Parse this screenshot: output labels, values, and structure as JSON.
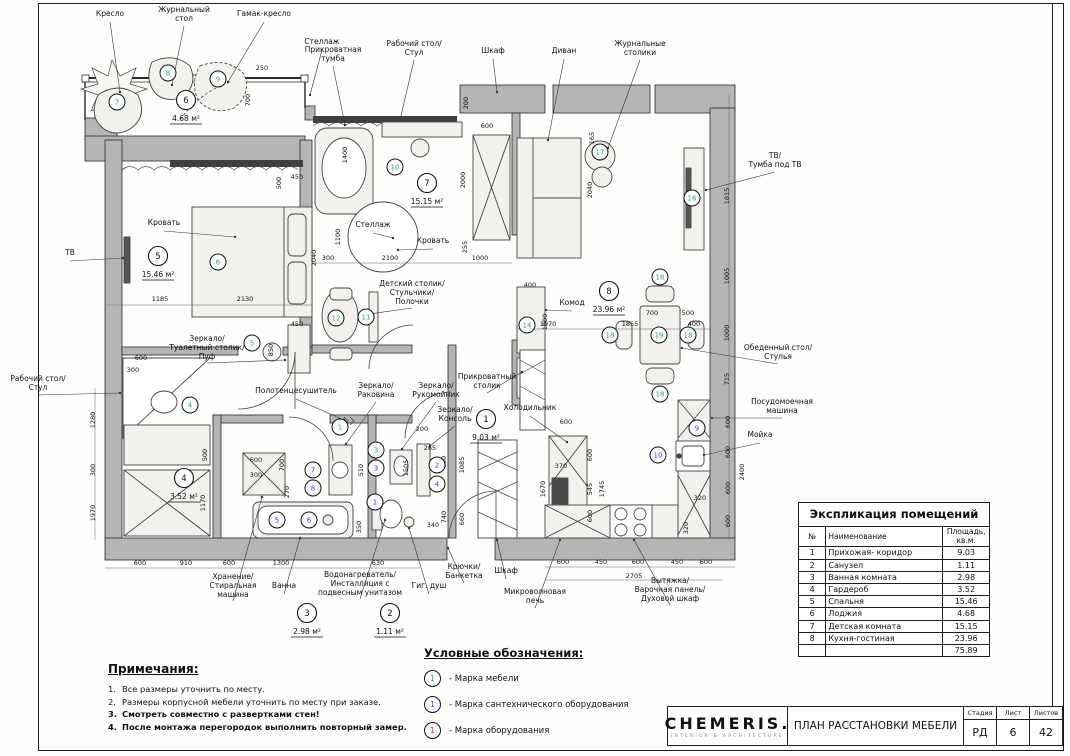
{
  "colors": {
    "furniture": "#2f9e8c",
    "plumbing": "#3646c8",
    "equipment": "#c04040",
    "wall": "#b5b5b5"
  },
  "titleBlock": {
    "logo": "CHEMERIS.",
    "logoSub": "INTERIOR & ARCHITECTURE",
    "docTitle": "ПЛАН РАССТАНОВКИ МЕБЕЛИ",
    "stageLabel": "Стадия",
    "sheetLabel": "Лист",
    "sheetsLabel": "Листов",
    "stage": "РД",
    "sheetNo": "6",
    "sheetsTotal": "42"
  },
  "explication": {
    "title": "Экспликация помещений",
    "colNo": "№",
    "colName": "Наименование",
    "colArea": "Площадь, кв.м.",
    "rows": [
      [
        "1",
        "Прихожая- коридор",
        "9.03"
      ],
      [
        "2",
        "Санузел",
        "1.11"
      ],
      [
        "3",
        "Ванная комната",
        "2.98"
      ],
      [
        "4",
        "Гардероб",
        "3.52"
      ],
      [
        "5",
        "Спальня",
        "15.46"
      ],
      [
        "6",
        "Лоджия",
        "4.68"
      ],
      [
        "7",
        "Детская комната",
        "15.15"
      ],
      [
        "8",
        "Кухня-гостиная",
        "23.96"
      ]
    ],
    "total": "75.89"
  },
  "legend": {
    "title": "Условные обозначения:",
    "items": [
      {
        "num": "1",
        "type": "furniture",
        "text": "- Марка мебели"
      },
      {
        "num": "1",
        "type": "plumbing",
        "text": "- Марка сантехнического оборудования"
      },
      {
        "num": "1",
        "type": "equipment",
        "text": "- Марка оборудования"
      }
    ]
  },
  "notes": {
    "title": "Примечания:",
    "items": [
      {
        "text": "Все размеры уточнить по месту.",
        "bold": false
      },
      {
        "text": "Размеры корпусной мебели уточнить по месту при заказе.",
        "bold": false
      },
      {
        "text": "Смотреть совместно с развертками стен!",
        "bold": true
      },
      {
        "text": "После монтажа перегородок выполнить повторный замер.",
        "bold": true
      }
    ]
  },
  "plan": {
    "roomMarks": [
      {
        "num": "5",
        "area": "15.46 м²",
        "x": 158,
        "y": 256
      },
      {
        "num": "6",
        "area": "4.68 м²",
        "x": 186,
        "y": 100
      },
      {
        "num": "7",
        "area": "15.15 м²",
        "x": 427,
        "y": 183
      },
      {
        "num": "8",
        "area": "23.96 м²",
        "x": 609,
        "y": 291
      },
      {
        "num": "4",
        "area": "3.52 м²",
        "x": 184,
        "y": 478
      },
      {
        "num": "1",
        "area": "9.03 м²",
        "x": 486,
        "y": 419
      },
      {
        "num": "3",
        "area": "2.98 м²",
        "x": 307,
        "y": 613
      },
      {
        "num": "2",
        "area": "1.11 м²",
        "x": 390,
        "y": 613
      }
    ],
    "labels": [
      {
        "text": "Кресло",
        "x": 110,
        "y": 16,
        "lx": 120,
        "ly": 92
      },
      {
        "text": "Журнальный\nстол",
        "x": 184,
        "y": 12,
        "lx": 172,
        "ly": 85
      },
      {
        "text": "Гамак-кресло",
        "x": 264,
        "y": 16,
        "lx": 228,
        "ly": 82
      },
      {
        "text": "Стеллаж",
        "x": 322,
        "y": 44,
        "lx": 310,
        "ly": 95
      },
      {
        "text": "Прикроватная\nтумба",
        "x": 333,
        "y": 52,
        "lx": 345,
        "ly": 125
      },
      {
        "text": "Рабочий стол/\nСтул",
        "x": 414,
        "y": 46,
        "lx": 400,
        "ly": 120
      },
      {
        "text": "Шкаф",
        "x": 493,
        "y": 53,
        "lx": 497,
        "ly": 92
      },
      {
        "text": "Диван",
        "x": 564,
        "y": 53,
        "lx": 548,
        "ly": 140
      },
      {
        "text": "Журнальные\nстолики",
        "x": 640,
        "y": 46,
        "lx": 608,
        "ly": 148
      },
      {
        "text": "ТВ/\nТумба под ТВ",
        "x": 775,
        "y": 158,
        "lx": 706,
        "ly": 190
      },
      {
        "text": "Обеденный стол/\nСтулья",
        "x": 778,
        "y": 350,
        "lx": 682,
        "ly": 348
      },
      {
        "text": "Посудомоечная\nмашина",
        "x": 782,
        "y": 404,
        "lx": 712,
        "ly": 418
      },
      {
        "text": "Мойка",
        "x": 760,
        "y": 437,
        "lx": 704,
        "ly": 455
      },
      {
        "text": "ТВ",
        "x": 70,
        "y": 255,
        "lx": 123,
        "ly": 258
      },
      {
        "text": "Рабочий стол/\nСтул",
        "x": 38,
        "y": 381,
        "lx": 120,
        "ly": 393
      },
      {
        "text": "Кровать",
        "x": 164,
        "y": 225,
        "lx": 235,
        "ly": 237
      },
      {
        "text": "Стеллаж",
        "x": 373,
        "y": 227,
        "lx": 393,
        "ly": 238
      },
      {
        "text": "Кровать",
        "x": 433,
        "y": 243,
        "lx": 398,
        "ly": 250
      },
      {
        "text": "Детский столик/\nСтульчики/\nПолочки",
        "x": 412,
        "y": 286,
        "lx": 362,
        "ly": 315
      },
      {
        "text": "Зеркало/\nТуалетный столик/\nПуф",
        "x": 207,
        "y": 341,
        "lx": 285,
        "ly": 360
      },
      {
        "text": "Комод",
        "x": 572,
        "y": 305,
        "lx": 546,
        "ly": 310
      },
      {
        "text": "Холодильник",
        "x": 530,
        "y": 410,
        "lx": 567,
        "ly": 442
      },
      {
        "text": "Полотенцесушитель",
        "x": 296,
        "y": 393,
        "lx": 344,
        "ly": 420
      },
      {
        "text": "Зеркало/\nРаковина",
        "x": 376,
        "y": 388,
        "lx": 346,
        "ly": 444
      },
      {
        "text": "Зеркало/\nРукомойник",
        "x": 436,
        "y": 388,
        "lx": 402,
        "ly": 449
      },
      {
        "text": "Зеркало/\nКонсоль",
        "x": 455,
        "y": 412,
        "lx": 430,
        "ly": 446
      },
      {
        "text": "Прикроватный\nстолик",
        "x": 487,
        "y": 379,
        "lx": 522,
        "ly": 372
      },
      {
        "text": "Хранение/\nСтиральная\nмашина",
        "x": 233,
        "y": 579,
        "lx": 262,
        "ly": 497
      },
      {
        "text": "Ванна",
        "x": 284,
        "y": 588,
        "lx": 300,
        "ly": 538
      },
      {
        "text": "Водонагреватель/\nИнсталляция с\nподвесным унитазом",
        "x": 360,
        "y": 577,
        "lx": 385,
        "ly": 520
      },
      {
        "text": "Гиг. душ",
        "x": 429,
        "y": 588,
        "lx": 409,
        "ly": 528
      },
      {
        "text": "Крючки/\nБанкетка",
        "x": 464,
        "y": 569,
        "lx": 448,
        "ly": 548
      },
      {
        "text": "Шкаф",
        "x": 506,
        "y": 573,
        "lx": 497,
        "ly": 540
      },
      {
        "text": "Микроволновая\nпечь",
        "x": 535,
        "y": 594,
        "lx": 560,
        "ly": 540
      },
      {
        "text": "Вытяжка/\nВарочная панель/\nДуховой шкаф",
        "x": 670,
        "y": 583,
        "lx": 634,
        "ly": 540
      }
    ],
    "marks": [
      {
        "n": "7",
        "x": 117,
        "y": 102,
        "c": "furniture"
      },
      {
        "n": "8",
        "x": 168,
        "y": 73,
        "c": "furniture"
      },
      {
        "n": "9",
        "x": 218,
        "y": 79,
        "c": "furniture"
      },
      {
        "n": "6",
        "x": 218,
        "y": 262,
        "c": "furniture"
      },
      {
        "n": "5",
        "x": 252,
        "y": 343,
        "c": "furniture"
      },
      {
        "n": "10",
        "x": 395,
        "y": 167,
        "c": "furniture"
      },
      {
        "n": "12",
        "x": 336,
        "y": 318,
        "c": "furniture"
      },
      {
        "n": "11",
        "x": 366,
        "y": 317,
        "c": "furniture"
      },
      {
        "n": "17",
        "x": 600,
        "y": 152,
        "c": "furniture"
      },
      {
        "n": "16",
        "x": 692,
        "y": 198,
        "c": "furniture"
      },
      {
        "n": "14",
        "x": 527,
        "y": 325,
        "c": "furniture"
      },
      {
        "n": "19",
        "x": 659,
        "y": 335,
        "c": "furniture"
      },
      {
        "n": "18",
        "x": 610,
        "y": 335,
        "c": "furniture"
      },
      {
        "n": "18",
        "x": 660,
        "y": 277,
        "c": "furniture"
      },
      {
        "n": "18",
        "x": 688,
        "y": 335,
        "c": "furniture"
      },
      {
        "n": "18",
        "x": 660,
        "y": 394,
        "c": "furniture"
      },
      {
        "n": "4",
        "x": 190,
        "y": 405,
        "c": "furniture"
      },
      {
        "n": "1",
        "x": 340,
        "y": 427,
        "c": "furniture"
      },
      {
        "n": "3",
        "x": 376,
        "y": 450,
        "c": "furniture"
      },
      {
        "n": "7",
        "x": 313,
        "y": 470,
        "c": "plumbing"
      },
      {
        "n": "8",
        "x": 313,
        "y": 488,
        "c": "plumbing"
      },
      {
        "n": "5",
        "x": 277,
        "y": 520,
        "c": "plumbing"
      },
      {
        "n": "6",
        "x": 309,
        "y": 520,
        "c": "plumbing"
      },
      {
        "n": "3",
        "x": 376,
        "y": 468,
        "c": "plumbing"
      },
      {
        "n": "1",
        "x": 375,
        "y": 502,
        "c": "plumbing"
      },
      {
        "n": "2",
        "x": 437,
        "y": 465,
        "c": "plumbing"
      },
      {
        "n": "4",
        "x": 437,
        "y": 484,
        "c": "plumbing"
      },
      {
        "n": "9",
        "x": 697,
        "y": 428,
        "c": "plumbing"
      },
      {
        "n": "10",
        "x": 658,
        "y": 455,
        "c": "plumbing"
      }
    ],
    "dims": [
      {
        "t": "250",
        "x": 262,
        "y": 70
      },
      {
        "t": "700",
        "x": 250,
        "y": 100,
        "v": 1
      },
      {
        "t": "600",
        "x": 487,
        "y": 128
      },
      {
        "t": "200",
        "x": 468,
        "y": 103,
        "v": 1
      },
      {
        "t": "2000",
        "x": 465,
        "y": 180,
        "v": 1
      },
      {
        "t": "255",
        "x": 467,
        "y": 247,
        "v": 1
      },
      {
        "t": "1000",
        "x": 480,
        "y": 260
      },
      {
        "t": "2100",
        "x": 390,
        "y": 260
      },
      {
        "t": "300",
        "x": 328,
        "y": 260
      },
      {
        "t": "1100",
        "x": 340,
        "y": 237,
        "v": 1
      },
      {
        "t": "1400",
        "x": 347,
        "y": 155,
        "v": 1
      },
      {
        "t": "450",
        "x": 297,
        "y": 179
      },
      {
        "t": "500",
        "x": 281,
        "y": 183,
        "v": 1
      },
      {
        "t": "1185",
        "x": 160,
        "y": 301
      },
      {
        "t": "2130",
        "x": 245,
        "y": 301
      },
      {
        "t": "2040",
        "x": 316,
        "y": 258,
        "v": 1
      },
      {
        "t": "450",
        "x": 297,
        "y": 326
      },
      {
        "t": "850",
        "x": 273,
        "y": 350,
        "v": 1
      },
      {
        "t": "600",
        "x": 141,
        "y": 360
      },
      {
        "t": "300",
        "x": 133,
        "y": 372
      },
      {
        "t": "1280",
        "x": 95,
        "y": 420,
        "v": 1
      },
      {
        "t": "300",
        "x": 95,
        "y": 470,
        "v": 1
      },
      {
        "t": "1970",
        "x": 95,
        "y": 513,
        "v": 1
      },
      {
        "t": "500",
        "x": 207,
        "y": 455,
        "v": 1
      },
      {
        "t": "1170",
        "x": 205,
        "y": 503,
        "v": 1
      },
      {
        "t": "600",
        "x": 256,
        "y": 462
      },
      {
        "t": "300",
        "x": 256,
        "y": 477
      },
      {
        "t": "700",
        "x": 284,
        "y": 465,
        "v": 1
      },
      {
        "t": "270",
        "x": 289,
        "y": 492,
        "v": 1
      },
      {
        "t": "1070",
        "x": 548,
        "y": 326
      },
      {
        "t": "1855",
        "x": 630,
        "y": 326
      },
      {
        "t": "400",
        "x": 694,
        "y": 326
      },
      {
        "t": "2040",
        "x": 592,
        "y": 190,
        "v": 1
      },
      {
        "t": "165",
        "x": 594,
        "y": 138,
        "v": 1
      },
      {
        "t": "400",
        "x": 530,
        "y": 287
      },
      {
        "t": "1000",
        "x": 547,
        "y": 322,
        "v": 1
      },
      {
        "t": "700",
        "x": 652,
        "y": 315
      },
      {
        "t": "500",
        "x": 688,
        "y": 315
      },
      {
        "t": "1815",
        "x": 729,
        "y": 196,
        "v": 1
      },
      {
        "t": "1005",
        "x": 729,
        "y": 276,
        "v": 1
      },
      {
        "t": "1000",
        "x": 729,
        "y": 333,
        "v": 1
      },
      {
        "t": "715",
        "x": 729,
        "y": 379,
        "v": 1
      },
      {
        "t": "600",
        "x": 730,
        "y": 422,
        "v": 1
      },
      {
        "t": "600",
        "x": 730,
        "y": 452,
        "v": 1
      },
      {
        "t": "600",
        "x": 730,
        "y": 488,
        "v": 1
      },
      {
        "t": "600",
        "x": 730,
        "y": 521,
        "v": 1
      },
      {
        "t": "2400",
        "x": 744,
        "y": 472,
        "v": 1
      },
      {
        "t": "320",
        "x": 700,
        "y": 500
      },
      {
        "t": "320",
        "x": 688,
        "y": 528,
        "v": 1
      },
      {
        "t": "600",
        "x": 566,
        "y": 424
      },
      {
        "t": "370",
        "x": 561,
        "y": 468
      },
      {
        "t": "1670",
        "x": 545,
        "y": 489,
        "v": 1
      },
      {
        "t": "600",
        "x": 592,
        "y": 455,
        "v": 1
      },
      {
        "t": "545",
        "x": 592,
        "y": 489,
        "v": 1
      },
      {
        "t": "1745",
        "x": 604,
        "y": 489,
        "v": 1
      },
      {
        "t": "600",
        "x": 592,
        "y": 516,
        "v": 1
      },
      {
        "t": "600",
        "x": 140,
        "y": 565
      },
      {
        "t": "910",
        "x": 186,
        "y": 565
      },
      {
        "t": "600",
        "x": 229,
        "y": 565
      },
      {
        "t": "1300",
        "x": 281,
        "y": 565
      },
      {
        "t": "630",
        "x": 378,
        "y": 565
      },
      {
        "t": "600",
        "x": 563,
        "y": 564
      },
      {
        "t": "450",
        "x": 601,
        "y": 564
      },
      {
        "t": "600",
        "x": 638,
        "y": 564
      },
      {
        "t": "450",
        "x": 677,
        "y": 564
      },
      {
        "t": "600",
        "x": 706,
        "y": 564
      },
      {
        "t": "2705",
        "x": 634,
        "y": 578
      },
      {
        "t": "200",
        "x": 422,
        "y": 431
      },
      {
        "t": "265",
        "x": 430,
        "y": 450
      },
      {
        "t": "1505",
        "x": 408,
        "y": 468,
        "v": 1
      },
      {
        "t": "510",
        "x": 363,
        "y": 470,
        "v": 1
      },
      {
        "t": "900",
        "x": 446,
        "y": 462,
        "v": 1
      },
      {
        "t": "1085",
        "x": 464,
        "y": 465,
        "v": 1
      },
      {
        "t": "340",
        "x": 433,
        "y": 527
      },
      {
        "t": "660",
        "x": 464,
        "y": 519,
        "v": 1
      },
      {
        "t": "740",
        "x": 446,
        "y": 517,
        "v": 1
      },
      {
        "t": "350",
        "x": 361,
        "y": 527,
        "v": 1
      }
    ]
  }
}
